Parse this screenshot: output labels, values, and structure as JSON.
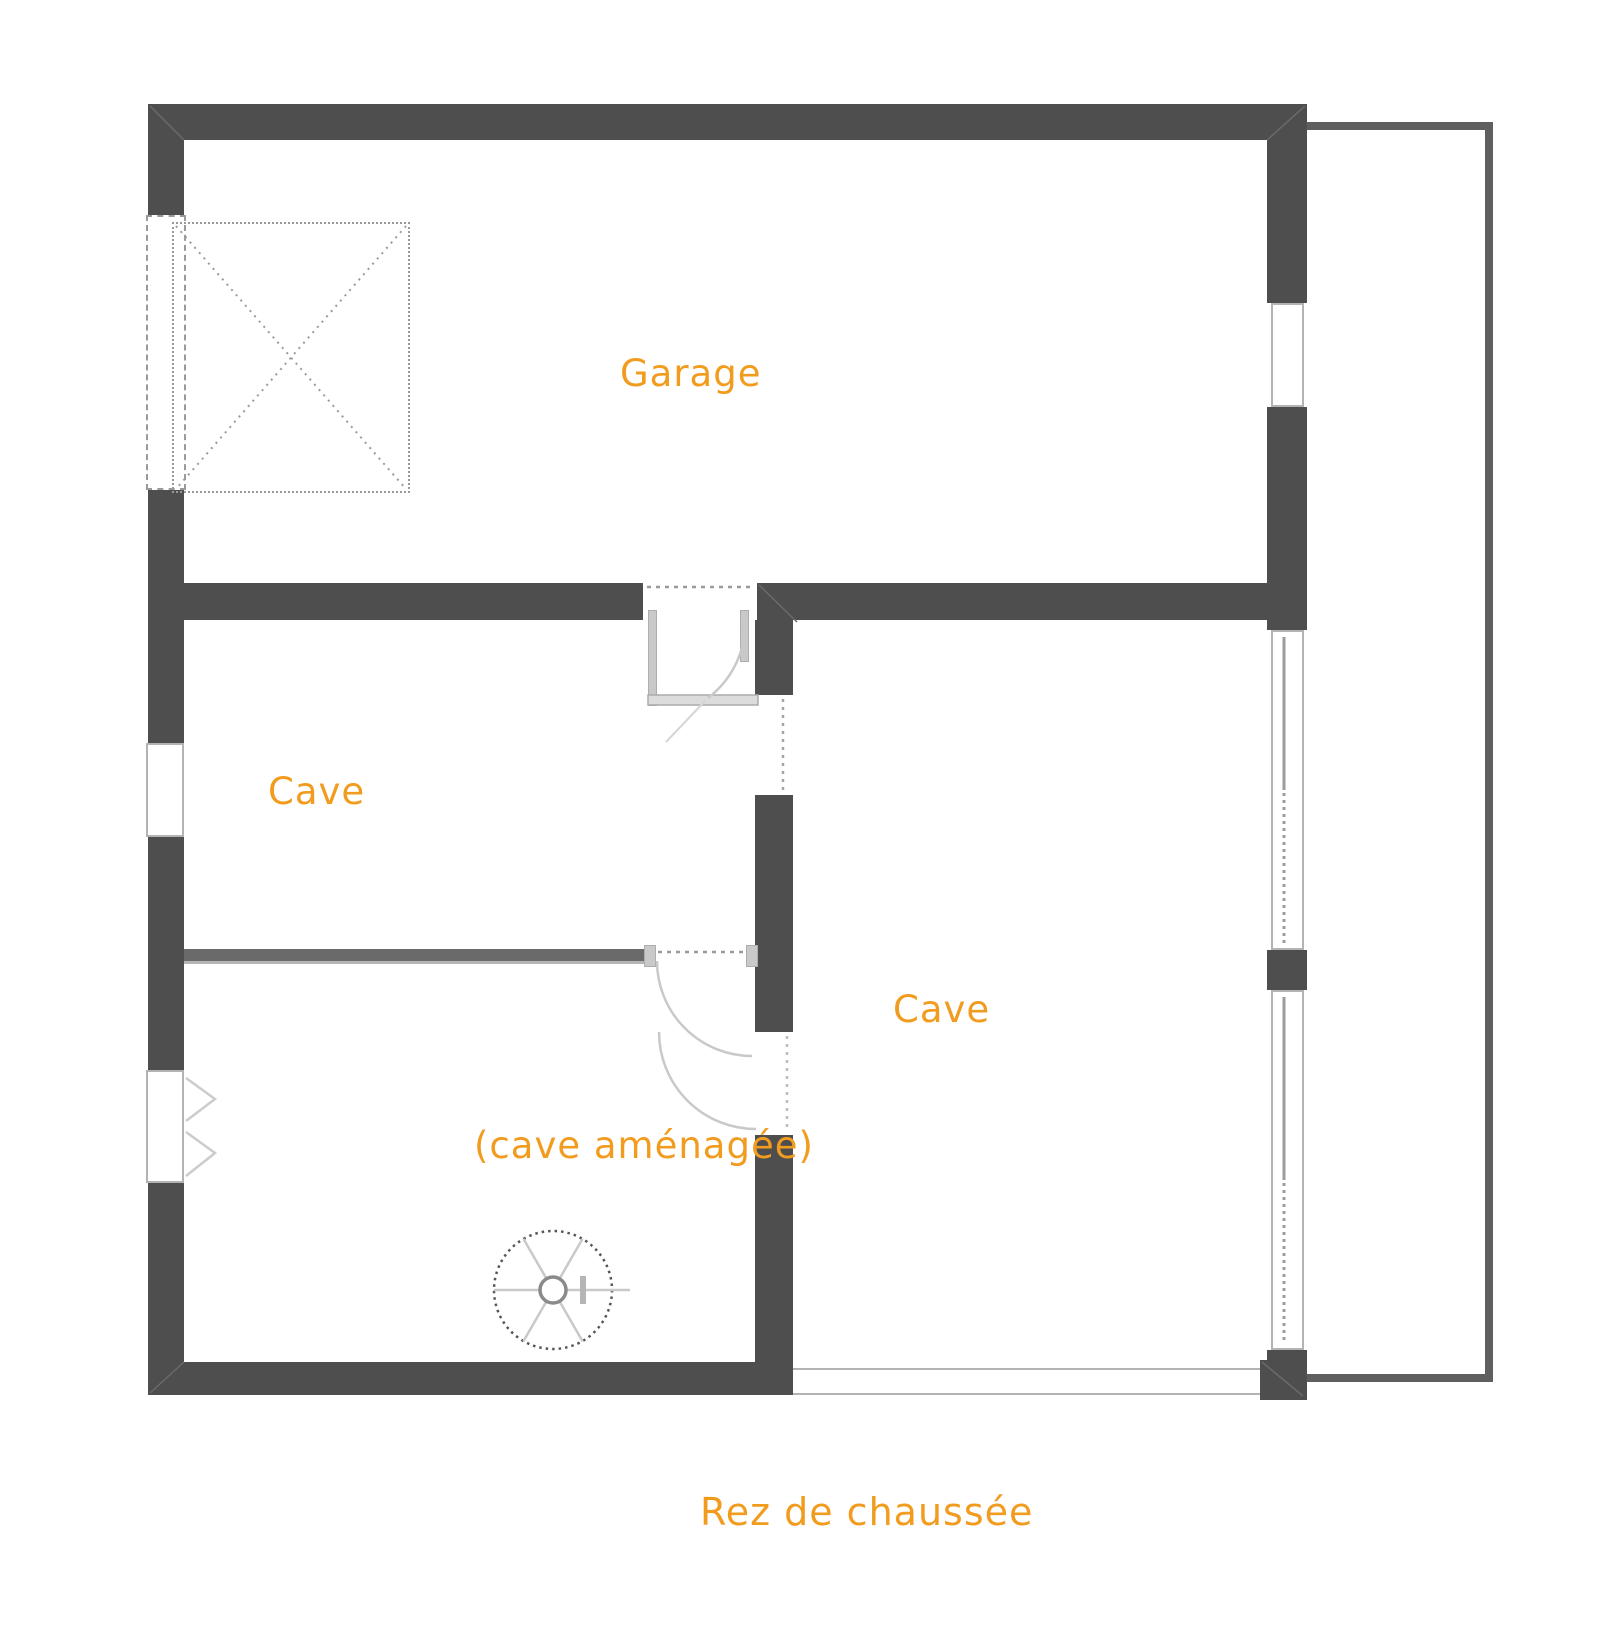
{
  "plan": {
    "caption": "Rez de chaussée",
    "rooms": [
      {
        "id": "garage",
        "label": "Garage"
      },
      {
        "id": "cave-left",
        "label": "Cave"
      },
      {
        "id": "cave-right",
        "label": "Cave"
      },
      {
        "id": "cave-amenagee",
        "label": "(cave aménagée)"
      }
    ],
    "icons": {
      "stair": "spiral-staircase-icon",
      "garage_marker": "garage-door-x-marker",
      "doors": "door-swing-arc",
      "windows": "window-opening"
    },
    "colors": {
      "wall": "#4e4e4e",
      "wall_thin": "#5f5f5f",
      "divider": "#6a6a6a",
      "window_frame": "#b3b3b3",
      "door_arc": "#c9c9c9",
      "dashed_marks": "#9a9a9a",
      "label_text": "#F29C1F",
      "background": "#ffffff"
    }
  }
}
